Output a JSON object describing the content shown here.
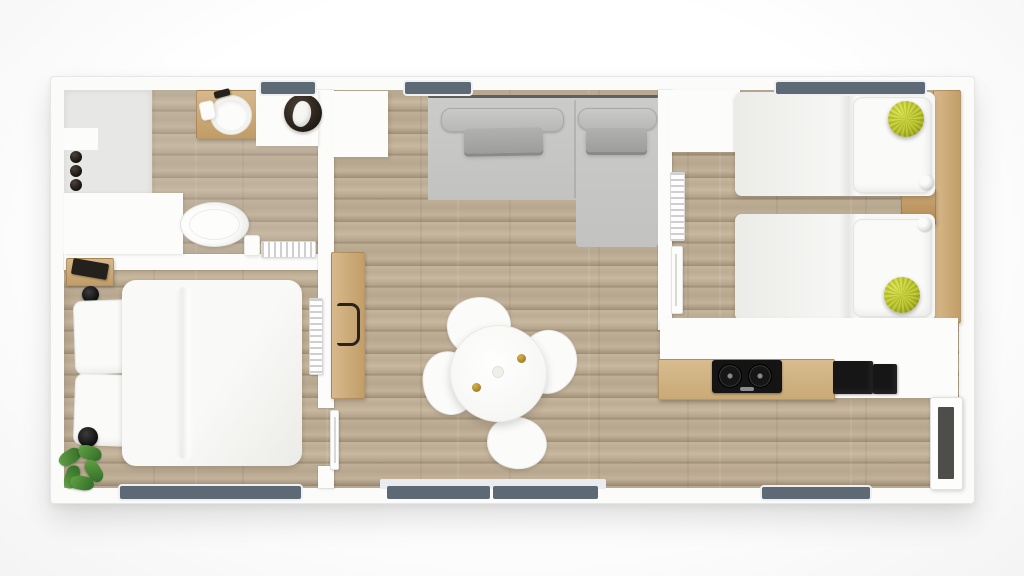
{
  "scene": {
    "type": "floor-plan",
    "view": "top-down-3d-render",
    "dwelling": "single-level tiny home / mobile home",
    "rooms": [
      {
        "name": "bathroom",
        "position": "top-left",
        "furniture": [
          "walk-in-shower",
          "shower-controls",
          "wood-vanity",
          "round-sink",
          "soap-dispenser",
          "faucet",
          "round-basin-with-towel",
          "toilet",
          "waste-bin",
          "towel-radiator",
          "window"
        ]
      },
      {
        "name": "bedroom",
        "position": "bottom-left",
        "furniture": [
          "double-bed",
          "two-pillows",
          "wood-nightstand",
          "black-gadget",
          "black-knob",
          "floor-lamp",
          "plant",
          "wall-radiator",
          "window"
        ]
      },
      {
        "name": "living-room",
        "position": "center",
        "furniture": [
          "corner-sofa-with-chaise",
          "back-bolsters",
          "two-gray-cushions",
          "white-closet",
          "wood-desk",
          "desk-chair",
          "round-dining-table",
          "four-white-chairs",
          "two-gold-cups",
          "window",
          "sliding-patio-door"
        ]
      },
      {
        "name": "kids-bedroom",
        "position": "top-right",
        "furniture": [
          "twin-bed-1",
          "twin-bed-2",
          "two-yellow-knot-pillows",
          "two-white-pompoms",
          "wood-headboard-shelf",
          "wood-nightstand",
          "white-wardrobe",
          "towel-radiator",
          "sliding-door",
          "window"
        ]
      },
      {
        "name": "kitchen",
        "position": "bottom-right",
        "furniture": [
          "white-counter",
          "wood-countertop",
          "two-burner-cooktop",
          "black-sink-unit",
          "black-niche",
          "entrance-door",
          "window"
        ]
      }
    ],
    "window_count": 5,
    "door_count": 3
  },
  "colors": {
    "bg": "#ffffff",
    "wall": "#fbfbfa",
    "wood": "#bcab93",
    "wood-plank-dark": "#9d8c74",
    "furniture-wood": "#c8a672",
    "shower-tray": "#e7e7e5",
    "sofa": "#c7c8c6",
    "sofa-cushion": "#a7a8a6",
    "bedding": "#f6f6f4",
    "window": "#5d6974",
    "door": "#4d4d49",
    "accent-yellow": "#c6d030",
    "plant-green": "#4c8a38",
    "appliance-black": "#161616",
    "gold": "#a97f1f"
  }
}
